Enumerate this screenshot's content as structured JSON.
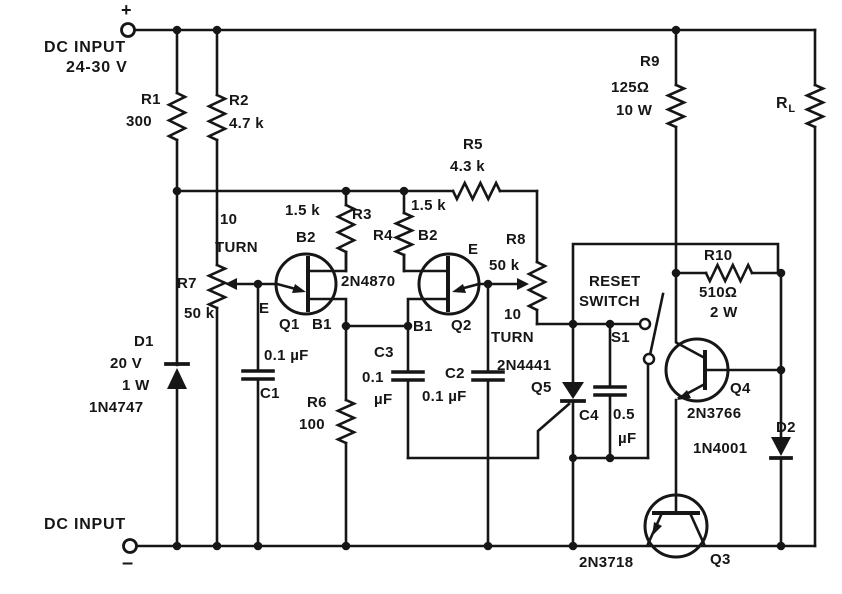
{
  "colors": {
    "ink": "#161616",
    "paper": "#ffffff"
  },
  "power": {
    "plus": "+",
    "minus": "–",
    "input_top_label": "DC INPUT",
    "input_top_range": "24-30 V",
    "input_bottom_label": "DC INPUT"
  },
  "components": {
    "r1": {
      "ref": "R1",
      "value": "300"
    },
    "r2": {
      "ref": "R2",
      "value": "4.7 k"
    },
    "r3": {
      "ref": "R3",
      "value": "1.5 k"
    },
    "r4": {
      "ref": "R4",
      "value": "1.5 k"
    },
    "r5": {
      "ref": "R5",
      "value": "4.3 k"
    },
    "r6": {
      "ref": "R6",
      "value": "100"
    },
    "r7": {
      "ref": "R7",
      "value": "50 k",
      "turns": "10",
      "turns_word": "TURN"
    },
    "r8": {
      "ref": "R8",
      "value": "50 k",
      "turns": "10",
      "turns_word": "TURN"
    },
    "r9": {
      "ref": "R9",
      "value": "125Ω",
      "power": "10 W"
    },
    "r10": {
      "ref": "R10",
      "value": "510Ω",
      "power": "2 W"
    },
    "rl": {
      "ref": "R",
      "sub": "L"
    },
    "c1": {
      "ref": "C1",
      "value": "0.1 µF"
    },
    "c2": {
      "ref": "C2",
      "value": "0.1 µF"
    },
    "c3": {
      "ref": "C3",
      "value": "0.1",
      "unit": "µF"
    },
    "c4": {
      "ref": "C4",
      "value": "0.5",
      "unit": "µF"
    },
    "d1": {
      "ref": "D1",
      "voltage": "20 V",
      "power": "1 W",
      "part": "1N4747"
    },
    "d2": {
      "ref": "D2",
      "part": "1N4001"
    },
    "q1": {
      "ref": "Q1",
      "part": "2N4870",
      "e": "E",
      "b1": "B1",
      "b2": "B2"
    },
    "q2": {
      "ref": "Q2",
      "e": "E",
      "b1": "B1",
      "b2": "B2"
    },
    "q3": {
      "ref": "Q3",
      "part": "2N3718"
    },
    "q4": {
      "ref": "Q4",
      "part": "2N3766"
    },
    "q5": {
      "ref": "Q5",
      "part": "2N4441"
    },
    "s1": {
      "ref": "S1",
      "label_line1": "RESET",
      "label_line2": "SWITCH"
    }
  }
}
